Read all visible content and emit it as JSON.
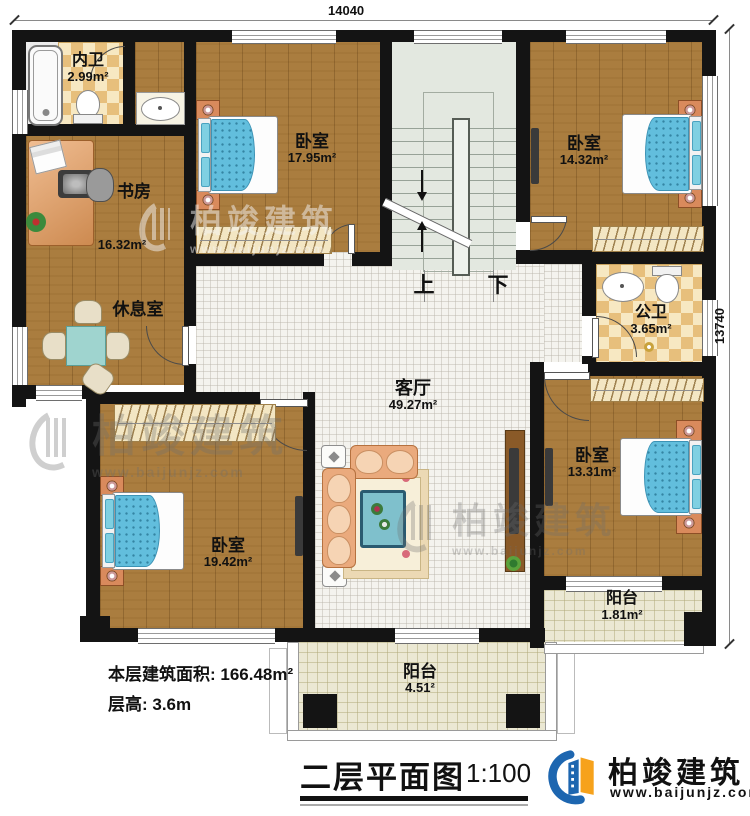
{
  "dimensions": {
    "top": "14040",
    "right": "13740"
  },
  "rooms": {
    "neiwei": {
      "name": "内卫",
      "area": "2.99m²"
    },
    "shufang": {
      "name": "书房",
      "area": "16.32m²"
    },
    "xiuxishi": {
      "name": "休息室"
    },
    "bedroom_top": {
      "name": "卧室",
      "area": "17.95m²"
    },
    "bedroom_ne": {
      "name": "卧室",
      "area": "14.32m²"
    },
    "gongwei": {
      "name": "公卫",
      "area": "3.65m²"
    },
    "bedroom_se": {
      "name": "卧室",
      "area": "13.31m²"
    },
    "bedroom_sw": {
      "name": "卧室",
      "area": "19.42m²"
    },
    "keting": {
      "name": "客厅",
      "area": "49.27m²"
    },
    "balcony_right": {
      "name": "阳台",
      "area": "1.81m²"
    },
    "balcony_bottom": {
      "name": "阳台",
      "area": "4.51²"
    }
  },
  "stairs": {
    "up": "上",
    "down": "下"
  },
  "notes": {
    "floor_area": "本层建筑面积: 166.48m²",
    "floor_height": "层高: 3.6m"
  },
  "title": {
    "text": "二层平面图",
    "scale": "1:100"
  },
  "brand": {
    "name": "柏竣建筑",
    "website": "www.baijunjz.com"
  },
  "watermark": {
    "name": "柏竣建筑",
    "website": "www.baijunjz.com"
  },
  "colors": {
    "wall": "#141414",
    "wood": "#aa7d3f",
    "tile": "#f4f3ee",
    "stair": "#e3e8e0",
    "checker_dark": "#e7bf7c",
    "checker_light": "#f7e8c2",
    "balcony": "#ebe8d3",
    "bed": "#62bedd",
    "logo_blue": "#1d66b0",
    "logo_orange": "#f6a21c"
  }
}
